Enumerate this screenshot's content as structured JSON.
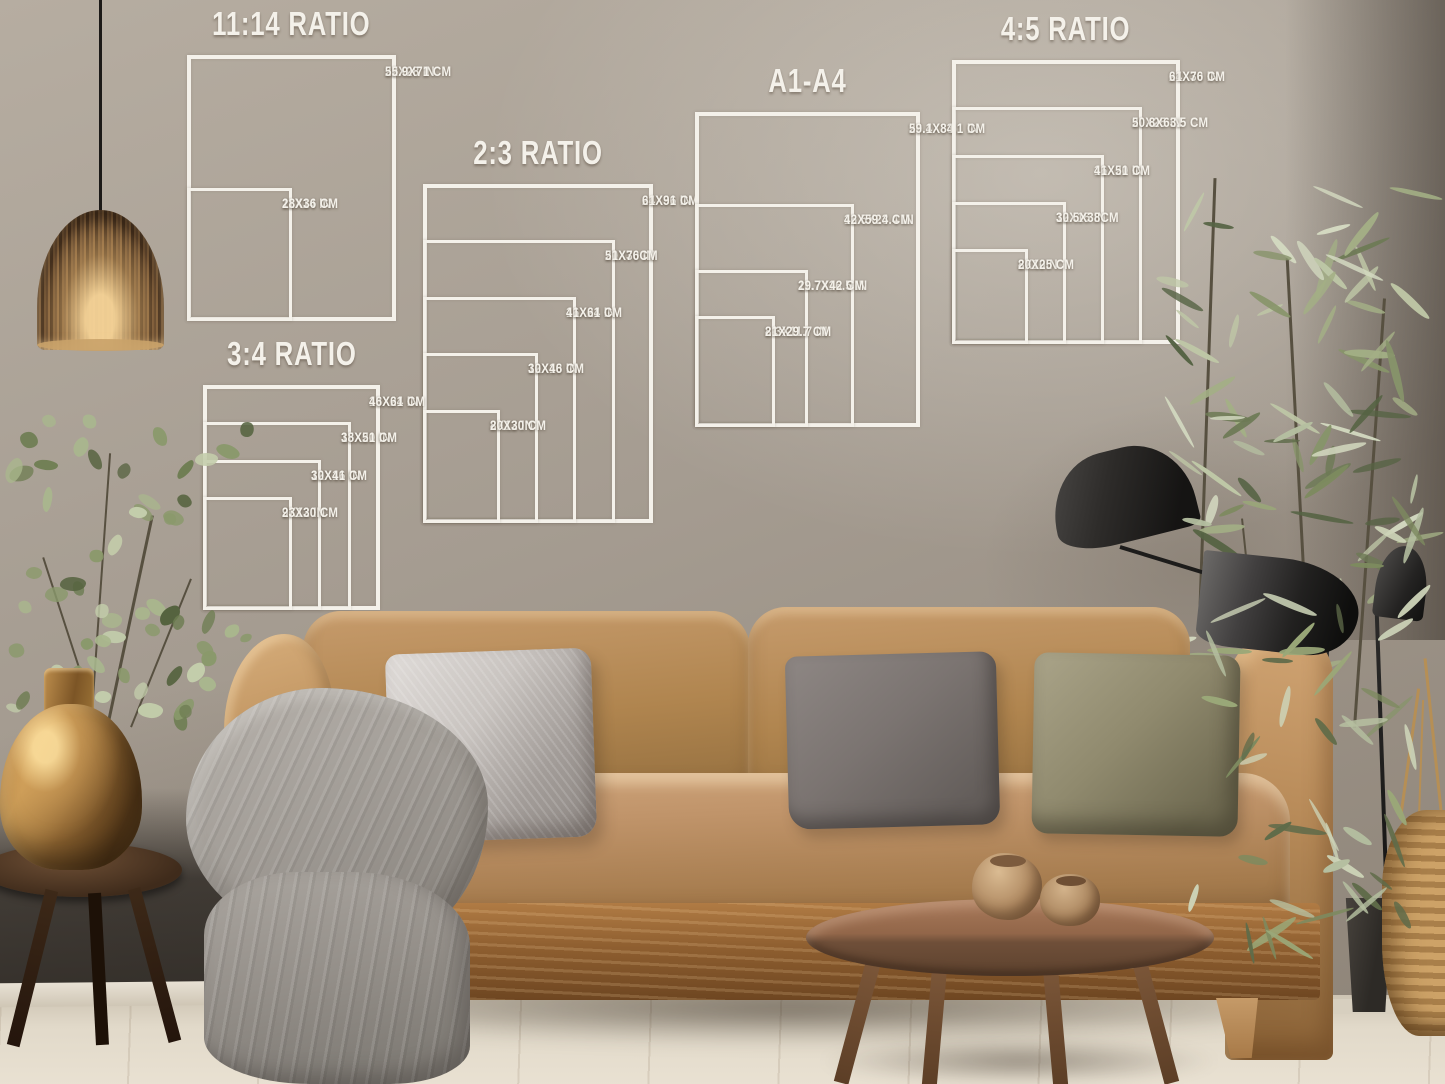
{
  "charts": [
    {
      "id": "ratio-11-14",
      "title": "11:14 RATIO",
      "sizes": [
        {
          "inches": "22X28 IN",
          "cm": "55.9X71 CM",
          "w": 22,
          "h": 28
        },
        {
          "inches": "11X14 IN",
          "cm": "28X36 CM",
          "w": 11,
          "h": 14
        }
      ]
    },
    {
      "id": "ratio-2-3",
      "title": "2:3 RATIO",
      "sizes": [
        {
          "inches": "24X36 IN",
          "cm": "61X91 CM",
          "w": 24,
          "h": 36
        },
        {
          "inches": "20X30 IN",
          "cm": "51X76CM",
          "w": 20,
          "h": 30
        },
        {
          "inches": "16X24 IN",
          "cm": "41X61 CM",
          "w": 16,
          "h": 24
        },
        {
          "inches": "12X18 IN",
          "cm": "30X46 CM",
          "w": 12,
          "h": 18
        },
        {
          "inches": "8X12 IN",
          "cm": "20X30 CM",
          "w": 8,
          "h": 12
        }
      ]
    },
    {
      "id": "ratio-3-4",
      "title": "3:4 RATIO",
      "sizes": [
        {
          "inches": "18X24 IN",
          "cm": "46X61 CM",
          "w": 18,
          "h": 24
        },
        {
          "inches": "15X20 IN",
          "cm": "38X51 CM",
          "w": 15,
          "h": 20
        },
        {
          "inches": "12X16 IN",
          "cm": "30X41 CM",
          "w": 12,
          "h": 16
        },
        {
          "inches": "9X12 IN",
          "cm": "23X30 CM",
          "w": 9,
          "h": 12
        }
      ]
    },
    {
      "id": "a1-a4",
      "title": "A1-A4",
      "sizes": [
        {
          "inches": "23.4X33.1 IN",
          "cm": "59.1X84.1 CM",
          "w": 23.4,
          "h": 33.1
        },
        {
          "inches": "16.5X23.4 IN",
          "cm": "42X59.4 CM",
          "w": 16.5,
          "h": 23.4
        },
        {
          "inches": "11.7X16.5 IN",
          "cm": "29.7X42 CM",
          "w": 11.7,
          "h": 16.5
        },
        {
          "inches": "8.3X11.7 IN",
          "cm": "21X29.7 CM",
          "w": 8.3,
          "h": 11.7
        }
      ]
    },
    {
      "id": "ratio-4-5",
      "title": "4:5 RATIO",
      "sizes": [
        {
          "inches": "24X30 IN",
          "cm": "61X76 CM",
          "w": 24,
          "h": 30
        },
        {
          "inches": "20X25 IN",
          "cm": "50.8X63.5 CM",
          "w": 20,
          "h": 25
        },
        {
          "inches": "16X20 IN",
          "cm": "41X51 CM",
          "w": 16,
          "h": 20
        },
        {
          "inches": "12X15 IN",
          "cm": "30.5X38CM",
          "w": 12,
          "h": 15
        },
        {
          "inches": "8X10IN",
          "cm": "20X25 CM",
          "w": 8,
          "h": 10
        }
      ]
    }
  ],
  "colors": {
    "chart_line": "#f4f1ea",
    "wall": "#a59c91",
    "sofa": "#b98a5c",
    "wood": "#8a5f3a"
  }
}
